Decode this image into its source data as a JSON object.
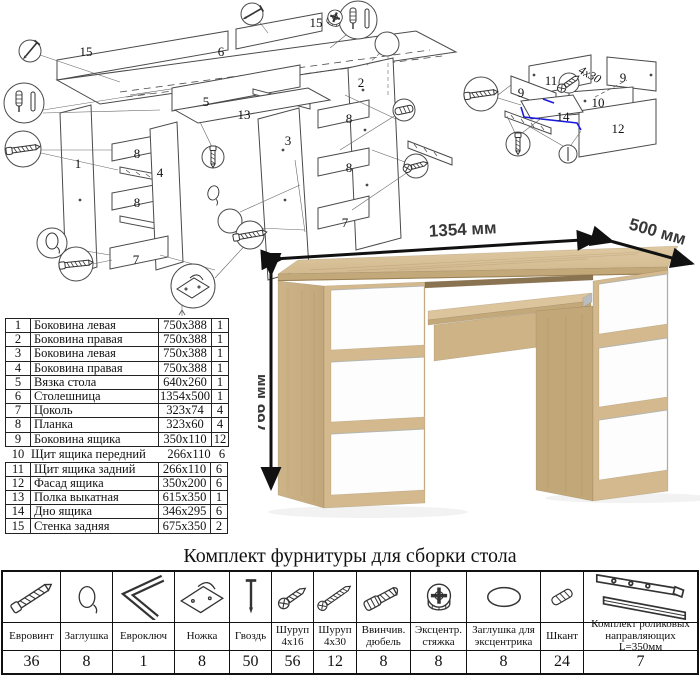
{
  "exploded_desk": {
    "labels": [
      "15",
      "6",
      "15",
      "5",
      "13",
      "1",
      "8",
      "4",
      "8",
      "7",
      "3",
      "2",
      "8",
      "8",
      "7"
    ]
  },
  "exploded_drawer": {
    "labels": [
      "11",
      "9",
      "9",
      "10",
      "12",
      "14"
    ],
    "screw_note": "4x30"
  },
  "desk_render": {
    "width_label": "1354 мм",
    "depth_label": "500 мм",
    "height_label": "766 мм",
    "colors": {
      "oak_light": "#dcc59d",
      "oak_mid": "#cdb488",
      "oak_dark": "#b79c6f",
      "drawer_white": "#fdfdfd"
    }
  },
  "parts_table": {
    "rows_top": [
      {
        "num": "1",
        "name": "Боковина левая",
        "size": "750x388",
        "qty": "1"
      },
      {
        "num": "2",
        "name": "Боковина правая",
        "size": "750x388",
        "qty": "1"
      },
      {
        "num": "3",
        "name": "Боковина левая",
        "size": "750x388",
        "qty": "1"
      },
      {
        "num": "4",
        "name": "Боковина правая",
        "size": "750x388",
        "qty": "1"
      },
      {
        "num": "5",
        "name": "Вязка стола",
        "size": "640x260",
        "qty": "1"
      },
      {
        "num": "6",
        "name": "Столешница",
        "size": "1354x500",
        "qty": "1"
      },
      {
        "num": "7",
        "name": "Цоколь",
        "size": "323x74",
        "qty": "4"
      },
      {
        "num": "8",
        "name": "Планка",
        "size": "323x60",
        "qty": "4"
      },
      {
        "num": "9",
        "name": "Боковина ящика",
        "size": "350x110",
        "qty": "12"
      }
    ],
    "row_middle": {
      "num": "10",
      "name": "Щит ящика передний",
      "size": "266x110",
      "qty": "6"
    },
    "rows_bottom": [
      {
        "num": "11",
        "name": "Щит ящика задний",
        "size": "266x110",
        "qty": "6"
      },
      {
        "num": "12",
        "name": "Фасад ящика",
        "size": "350x200",
        "qty": "6"
      },
      {
        "num": "13",
        "name": "Полка выкатная",
        "size": "615x350",
        "qty": "1"
      },
      {
        "num": "14",
        "name": "Дно ящика",
        "size": "346x295",
        "qty": "6"
      },
      {
        "num": "15",
        "name": "Стенка задняя",
        "size": "675x350",
        "qty": "2"
      }
    ]
  },
  "hardware": {
    "title": "Комплект фурнитуры для сборки стола",
    "items": [
      {
        "name": "Евровинт",
        "qty": "36",
        "icon": "euro-screw-icon"
      },
      {
        "name": "Заглушка",
        "qty": "8",
        "icon": "cap-icon"
      },
      {
        "name": "Евроключ",
        "qty": "1",
        "icon": "hex-key-icon"
      },
      {
        "name": "Ножка",
        "qty": "8",
        "icon": "foot-icon"
      },
      {
        "name": "Гвоздь",
        "qty": "50",
        "icon": "nail-icon"
      },
      {
        "name": "Шуруп 4x16",
        "qty": "56",
        "icon": "screw-short-icon"
      },
      {
        "name": "Шуруп 4x30",
        "qty": "12",
        "icon": "screw-long-icon"
      },
      {
        "name": "Ввинчив. дюбель",
        "qty": "8",
        "icon": "screw-in-dowel-icon"
      },
      {
        "name": "Эксцентр. стяжка",
        "qty": "8",
        "icon": "cam-lock-icon"
      },
      {
        "name": "Заглушка для эксцентрика",
        "qty": "8",
        "icon": "cam-cap-icon"
      },
      {
        "name": "Шкант",
        "qty": "24",
        "icon": "wood-dowel-icon"
      },
      {
        "name": "Комплект роликовых направляющих L=350мм",
        "qty": "7",
        "icon": "drawer-slides-icon"
      }
    ]
  }
}
